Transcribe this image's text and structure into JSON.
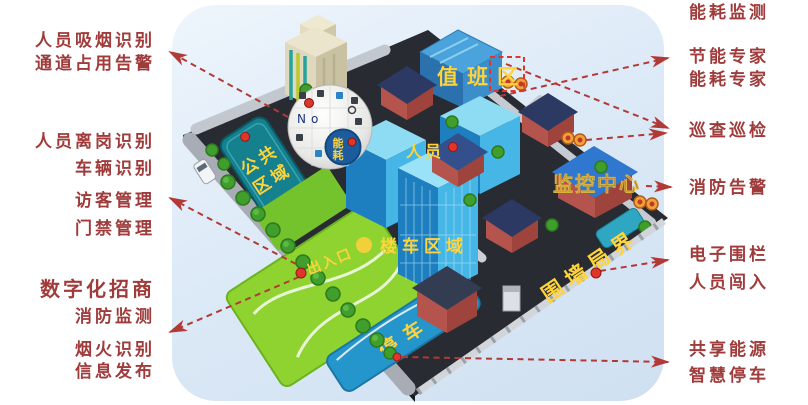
{
  "labels": {
    "left": [
      {
        "text": "人员吸烟识别"
      },
      {
        "text": "通道占用告警"
      },
      {
        "text": "人员离岗识别"
      },
      {
        "text": "车辆识别"
      },
      {
        "text": "访客管理"
      },
      {
        "text": "门禁管理"
      },
      {
        "text": "数字化招商"
      },
      {
        "text": "消防监测"
      },
      {
        "text": "烟火识别"
      },
      {
        "text": "信息发布"
      }
    ],
    "right": [
      {
        "text": "能耗监测"
      },
      {
        "text": "节能专家"
      },
      {
        "text": "能耗专家"
      },
      {
        "text": "巡查巡检"
      },
      {
        "text": "消防告警"
      },
      {
        "text": "电子围栏"
      },
      {
        "text": "人员闯入"
      },
      {
        "text": "共享能源"
      },
      {
        "text": "智慧停车"
      }
    ]
  },
  "map": {
    "duty_area": "值班区",
    "personnel": "人员",
    "public_area_l1": "公共",
    "public_area_l2": "区域",
    "entrance": "出入口",
    "vehicle_area": "楼车区域",
    "parking": "停车",
    "perimeter": "围墙局界",
    "monitoring_center": "监控中心",
    "energy_l1": "能",
    "energy_l2": "耗",
    "hub_sign": "No"
  },
  "colors": {
    "annotation_red": "#a03b3b",
    "arrow_red": "#b23a36",
    "map_label_yellow": "#ffd43a",
    "monitoring_red": "#8f2a20",
    "alert_dot_red": "#e0352b",
    "panel_blue": "#ddeaf7"
  }
}
